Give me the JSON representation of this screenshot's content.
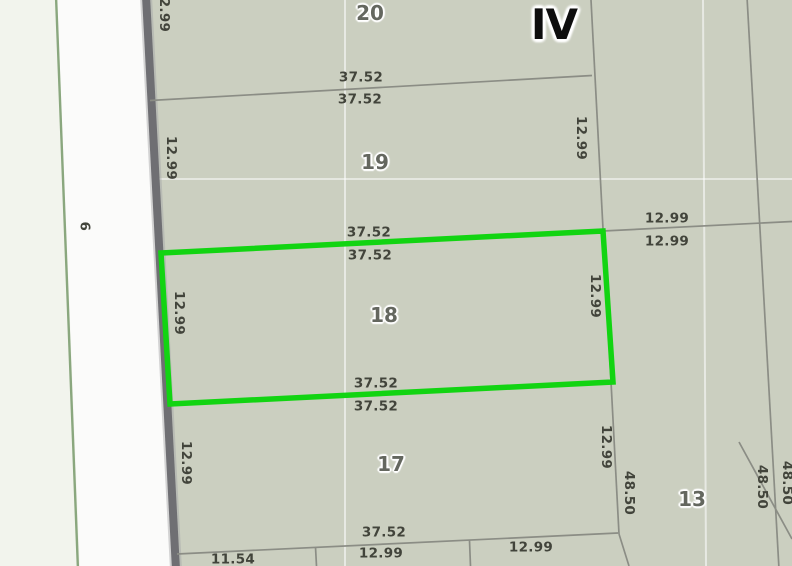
{
  "map": {
    "block_number": "IV",
    "street_number": "9",
    "selected_parcel": "18",
    "colors": {
      "highlight_green": "#12d412",
      "parcel_fill": "#cbcfc0",
      "road_fill": "#fbfbfa",
      "west_strip_fill": "#f2f4ed",
      "street_edge_green": "#8aa77e",
      "road_casing_gray": "#6f6f73",
      "boundary_gray": "#8b8d85",
      "dimension_text": "#42443b",
      "parcel_number_text": "#64675f",
      "block_text": "#0e0e0e"
    },
    "parcel_labels": [
      {
        "text": "20",
        "x": 370,
        "y": 13,
        "rot": 0
      },
      {
        "text": "19",
        "x": 375,
        "y": 162,
        "rot": 0
      },
      {
        "text": "18",
        "x": 384,
        "y": 315,
        "rot": 0
      },
      {
        "text": "17",
        "x": 391,
        "y": 464,
        "rot": 0
      },
      {
        "text": "13",
        "x": 692,
        "y": 499,
        "rot": 0
      }
    ],
    "block_labels": [
      {
        "text": "IV",
        "x": 554,
        "y": 25,
        "rot": 0
      }
    ],
    "street_labels": [
      {
        "text": "9",
        "x": 87,
        "y": 226,
        "rot": -90
      }
    ],
    "dimension_labels": [
      {
        "text": "2.99",
        "x": 163,
        "y": 15,
        "rot": 90
      },
      {
        "text": "37.52",
        "x": 361,
        "y": 78,
        "rot": 0
      },
      {
        "text": "37.52",
        "x": 360,
        "y": 100,
        "rot": 0
      },
      {
        "text": "12.99",
        "x": 170,
        "y": 158,
        "rot": 90
      },
      {
        "text": "12.99",
        "x": 580,
        "y": 138,
        "rot": 90
      },
      {
        "text": "12.99",
        "x": 667,
        "y": 219,
        "rot": 0
      },
      {
        "text": "12.99",
        "x": 667,
        "y": 242,
        "rot": 0
      },
      {
        "text": "37.52",
        "x": 369,
        "y": 233,
        "rot": 0
      },
      {
        "text": "37.52",
        "x": 370,
        "y": 256,
        "rot": 0
      },
      {
        "text": "12.99",
        "x": 178,
        "y": 313,
        "rot": 90
      },
      {
        "text": "12.99",
        "x": 594,
        "y": 296,
        "rot": 90
      },
      {
        "text": "37.52",
        "x": 376,
        "y": 384,
        "rot": 0
      },
      {
        "text": "37.52",
        "x": 376,
        "y": 407,
        "rot": 0
      },
      {
        "text": "12.99",
        "x": 185,
        "y": 463,
        "rot": 90
      },
      {
        "text": "12.99",
        "x": 605,
        "y": 447,
        "rot": 90
      },
      {
        "text": "48.50",
        "x": 628,
        "y": 493,
        "rot": 90
      },
      {
        "text": "48.50",
        "x": 761,
        "y": 487,
        "rot": 90
      },
      {
        "text": "48.50",
        "x": 786,
        "y": 483,
        "rot": 90
      },
      {
        "text": "37.52",
        "x": 384,
        "y": 533,
        "rot": 0
      },
      {
        "text": "11.54",
        "x": 233,
        "y": 560,
        "rot": 0
      },
      {
        "text": "12.99",
        "x": 381,
        "y": 554,
        "rot": 0
      },
      {
        "text": "12.99",
        "x": 531,
        "y": 548,
        "rot": 0
      }
    ]
  }
}
